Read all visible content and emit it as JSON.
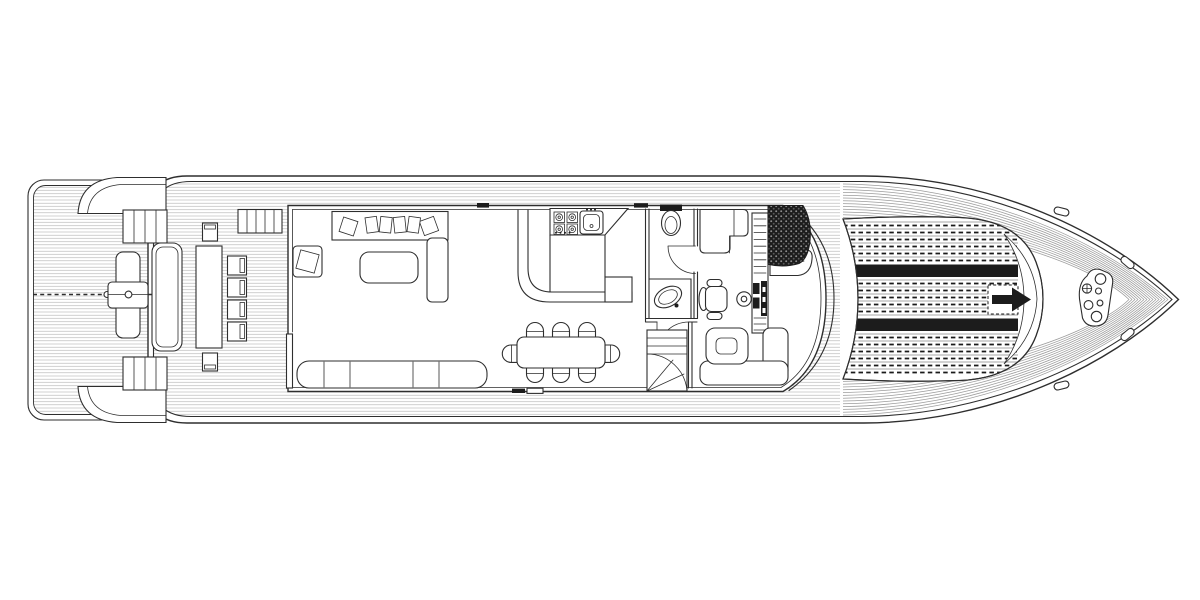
{
  "document": {
    "kind": "yacht main deck floor plan",
    "view": "top-down technical line drawing, black on white",
    "orientation": "bow pointing right",
    "visible_text": ""
  },
  "palette": {
    "paper": "#ffffff",
    "line": "#2e2e2e",
    "hatch": "#b4b4b4",
    "planking": "#9c9c9c",
    "dark_fill": "#1c1c1c"
  },
  "legend": {
    "areas": [
      {
        "id": "swim-platform",
        "name": "stern swim platform with passerelle and centerline"
      },
      {
        "id": "stern-stairs",
        "name": "port and starboard stairs from swim platform"
      },
      {
        "id": "aft-deck",
        "name": "aft deck with long table, six chairs, transom bench"
      },
      {
        "id": "salon",
        "name": "salon with pillow sofa, armchair, coffee table, bench sofa"
      },
      {
        "id": "galley",
        "name": "galley with four-burner stove, sink, L-shaped counter"
      },
      {
        "id": "dining",
        "name": "dining table with eight chairs"
      },
      {
        "id": "day-head",
        "name": "day head with toilet and vanity sink"
      },
      {
        "id": "pilothouse",
        "name": "pilothouse with helm chair, wheel, instrument console, sofa, dinette"
      },
      {
        "id": "flybridge-stairs",
        "name": "dark-hatched stairway up to flybridge"
      },
      {
        "id": "lower-stairs",
        "name": "winder stairs down to lower deck"
      },
      {
        "id": "foredeck-sunpad",
        "name": "quilted foredeck sun pad with two dark straps and hatch arrow"
      },
      {
        "id": "bow",
        "name": "bow with anchor windlass plate and four cleats"
      }
    ]
  },
  "decor": {
    "bow_ring_count": 14,
    "quilt_bands": [
      [
        221,
        262
      ],
      [
        279,
        317
      ],
      [
        333,
        376
      ]
    ],
    "quilt_step": 7,
    "quilt_x": [
      820,
      1018
    ],
    "stripe_bands": [
      [
        264.5,
        277
      ],
      [
        318.5,
        331
      ]
    ]
  }
}
